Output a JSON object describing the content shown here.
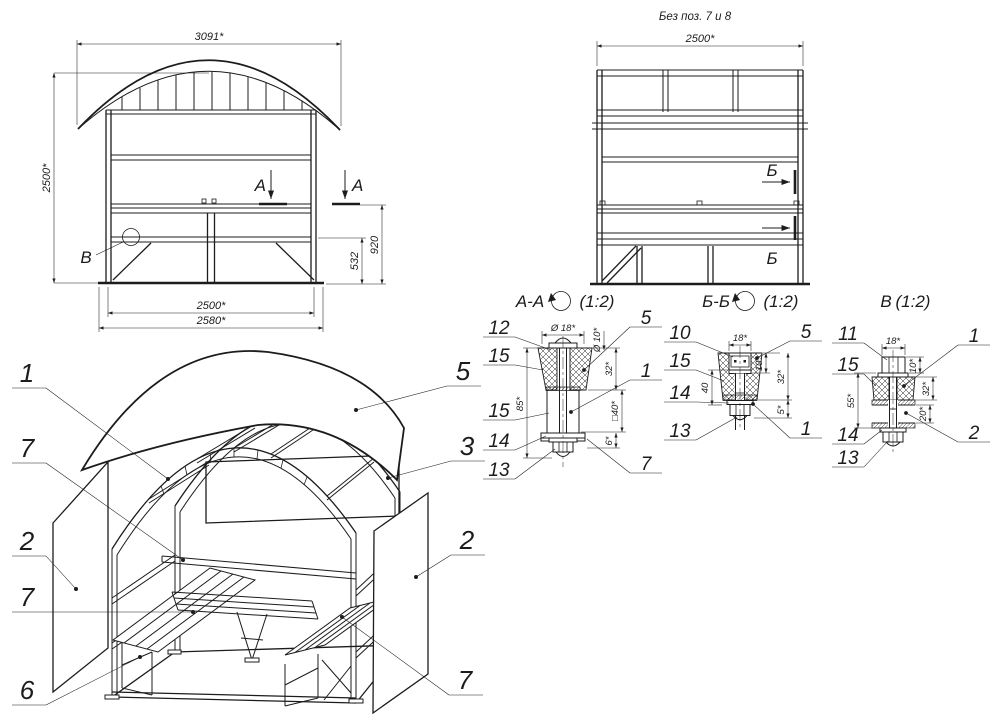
{
  "front_view": {
    "dim_top": "3091*",
    "dim_left": "2500*",
    "dim_bottom_inner": "2500*",
    "dim_bottom_outer": "2580*",
    "dim_right_outer": "920",
    "dim_right_inner": "532",
    "section_marker": "А",
    "detail_marker": "В"
  },
  "side_view": {
    "note": "Без поз. 7 и 8",
    "dim_top": "2500*",
    "section_marker": "Б"
  },
  "section_aa": {
    "title": "А-А",
    "scale": "(1:2)",
    "callouts_left": [
      "12",
      "15",
      "15",
      "14",
      "13"
    ],
    "callouts_right": [
      "5",
      "1",
      "7"
    ],
    "dim_width": "Ø 18*",
    "dim_bolt": "Ø 10*",
    "dim_h1": "32*",
    "dim_tube": "□40*",
    "dim_h2": "6*",
    "dim_total": "85*"
  },
  "section_bb": {
    "title": "Б-Б",
    "scale": "(1:2)",
    "callouts_left": [
      "10",
      "15",
      "14",
      "13"
    ],
    "callouts_right": [
      "5",
      "1"
    ],
    "dim_width": "18*",
    "dim_head": "10*",
    "dim_h1": "32*",
    "dim_h2": "5*",
    "dim_left": "40"
  },
  "section_v": {
    "title": "В",
    "scale": "(1:2)",
    "callouts_left": [
      "11",
      "15",
      "14",
      "13"
    ],
    "callouts_right": [
      "1",
      "2"
    ],
    "dim_width": "18*",
    "dim_head": "10*",
    "dim_h1": "32*",
    "dim_h2": "20*",
    "dim_left": "55*"
  },
  "exploded_view": {
    "callouts_left": [
      "1",
      "7",
      "2",
      "7",
      "6"
    ],
    "callouts_right": [
      "5",
      "3",
      "2",
      "7"
    ]
  }
}
